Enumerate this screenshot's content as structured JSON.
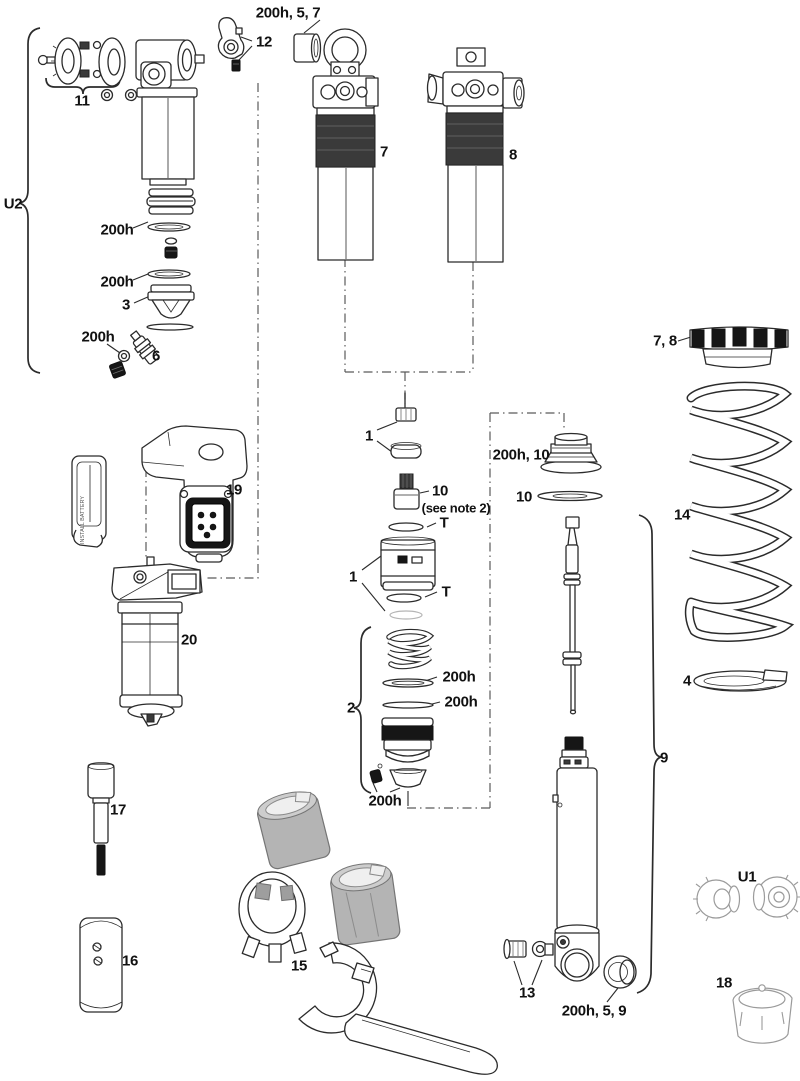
{
  "diagram": {
    "labels": {
      "bumper_757": "200h, 5, 7",
      "n12": "12",
      "n11": "11",
      "u2": "U2",
      "seal_a": "200h",
      "seal_b": "200h",
      "n3": "3",
      "seal_c": "200h",
      "n6": "6",
      "n7": "7",
      "n8": "8",
      "n78": "7, 8",
      "n14": "14",
      "n4": "4",
      "n1a": "1",
      "n10a": "10",
      "note2": "(see note 2)",
      "t_a": "T",
      "cups_200h10": "200h, 10",
      "n10b": "10",
      "n1b": "1",
      "t_b": "T",
      "n2": "2",
      "seal_d": "200h",
      "seal_e": "200h",
      "seal_f": "200h",
      "n19": "19",
      "n20": "20",
      "n17": "17",
      "n16": "16",
      "n15": "15",
      "n13": "13",
      "bushing_20059": "200h, 5, 9",
      "n9": "9",
      "u1": "U1",
      "n18": "18",
      "battery_text": "INSTALL BATTERY"
    },
    "colors": {
      "line": "#2b2b2b",
      "dark_band": "#3a3a3a",
      "black_part": "#161616",
      "tool_gray": "#b4b4b4",
      "faint_part": "#9b9b9b",
      "background": "#ffffff"
    }
  }
}
